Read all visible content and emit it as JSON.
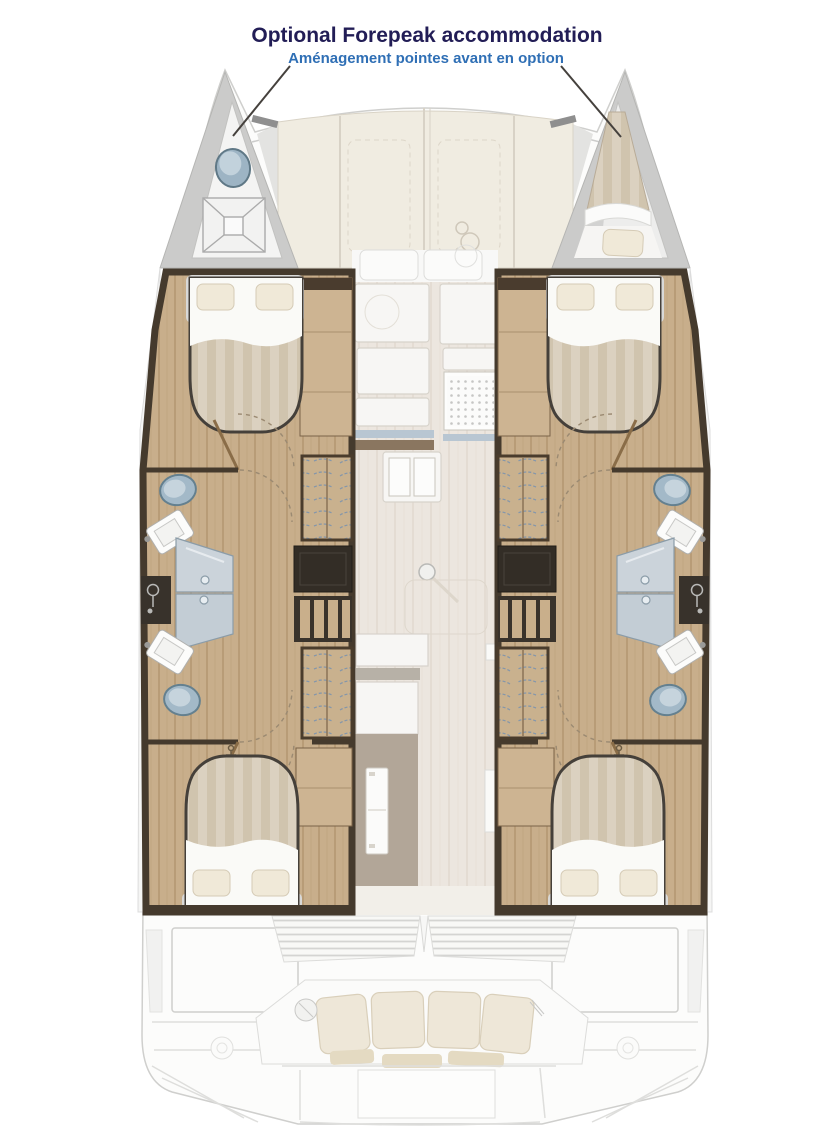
{
  "page": {
    "width": 828,
    "height": 1129,
    "background": "#ffffff"
  },
  "annotation": {
    "title": "Optional Forepeak accommodation",
    "subtitle": "Aménagement pointes avant en option",
    "title_color": "#221d56",
    "subtitle_color": "#2f6fb5"
  },
  "diagram": {
    "type": "catamaran-deck-plan",
    "features": {
      "port_forepeak": "Forepeak wet area with toilet and shower tray",
      "starboard_forepeak": "Forepeak berth with mattress and pillow",
      "foredeck": "Foredeck lounge panels",
      "windlass": "Anchor windlass",
      "port_forward_cabin": "Forward double cabin (island bed, two pillows)",
      "port_aft_cabin": "Aft double cabin (island bed, two pillows)",
      "starboard_hull": "Starboard hull (mirrored cabins and bathrooms)",
      "bathroom_forward": "Bathroom: toilet, basin, shower enclosure",
      "bathroom_aft": "Bathroom: toilet, basin, shower enclosure",
      "shower_column": "Shower mixer column",
      "wardrobe": "Hanging locker",
      "stairs": "Companionway steps to hull",
      "desk": "Chart desk unit",
      "galley": "Galley worktops and sink",
      "stove": "Cooktop grid",
      "mast": "Mast foot",
      "island": "Galley island",
      "fridge": "Refrigerator",
      "saloon": "Saloon sole",
      "cockpit_bench": "Aft cockpit bench seat",
      "transom": "Transom platform and steps",
      "stern_locker": "Stern deck locker"
    },
    "colors": {
      "deck_cream": "#f0ece1",
      "wood_floor": "#c8ae8b",
      "dark_wood": "#453a2d",
      "wardrobe_tan": "#c9b18e",
      "shower_glass": "#cbd3da",
      "ceramic_blue": "#a3b9c8",
      "mattress": "#d8cdbd",
      "saloon_floor": "#ece6df",
      "taupe": "#b2a698",
      "ghost_line": "#d6d6d6"
    }
  }
}
